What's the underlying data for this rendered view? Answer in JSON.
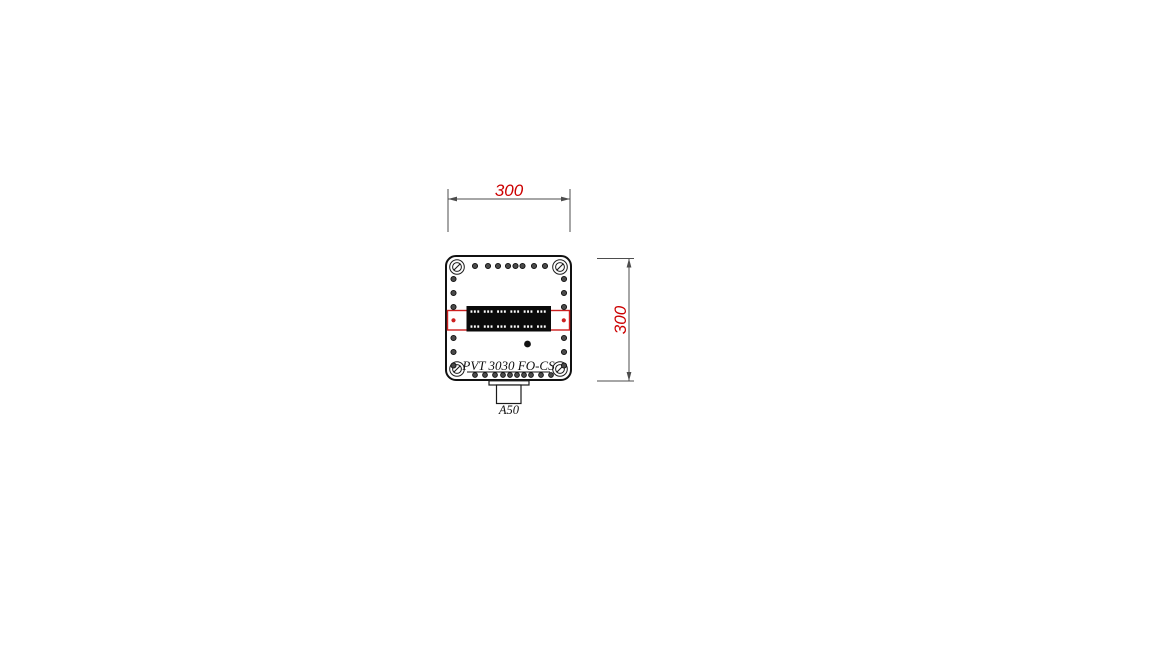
{
  "page": {
    "background": "#ffffff",
    "description": "Technical drawing of PVT 3030 FO-CS enclosure, front view with dimensions"
  },
  "colors": {
    "outline": "#111111",
    "dimension_line": "#4d4d4d",
    "dimension_text": "#cc0000",
    "rail_red": "#cc2020",
    "hole_fill": "#4a4a4a",
    "block_fill": "#0a0a0a"
  },
  "labels": {
    "width_dimension": "300",
    "height_dimension": "300",
    "product": "PVT 3030 FO-CS",
    "connector": "A50"
  }
}
